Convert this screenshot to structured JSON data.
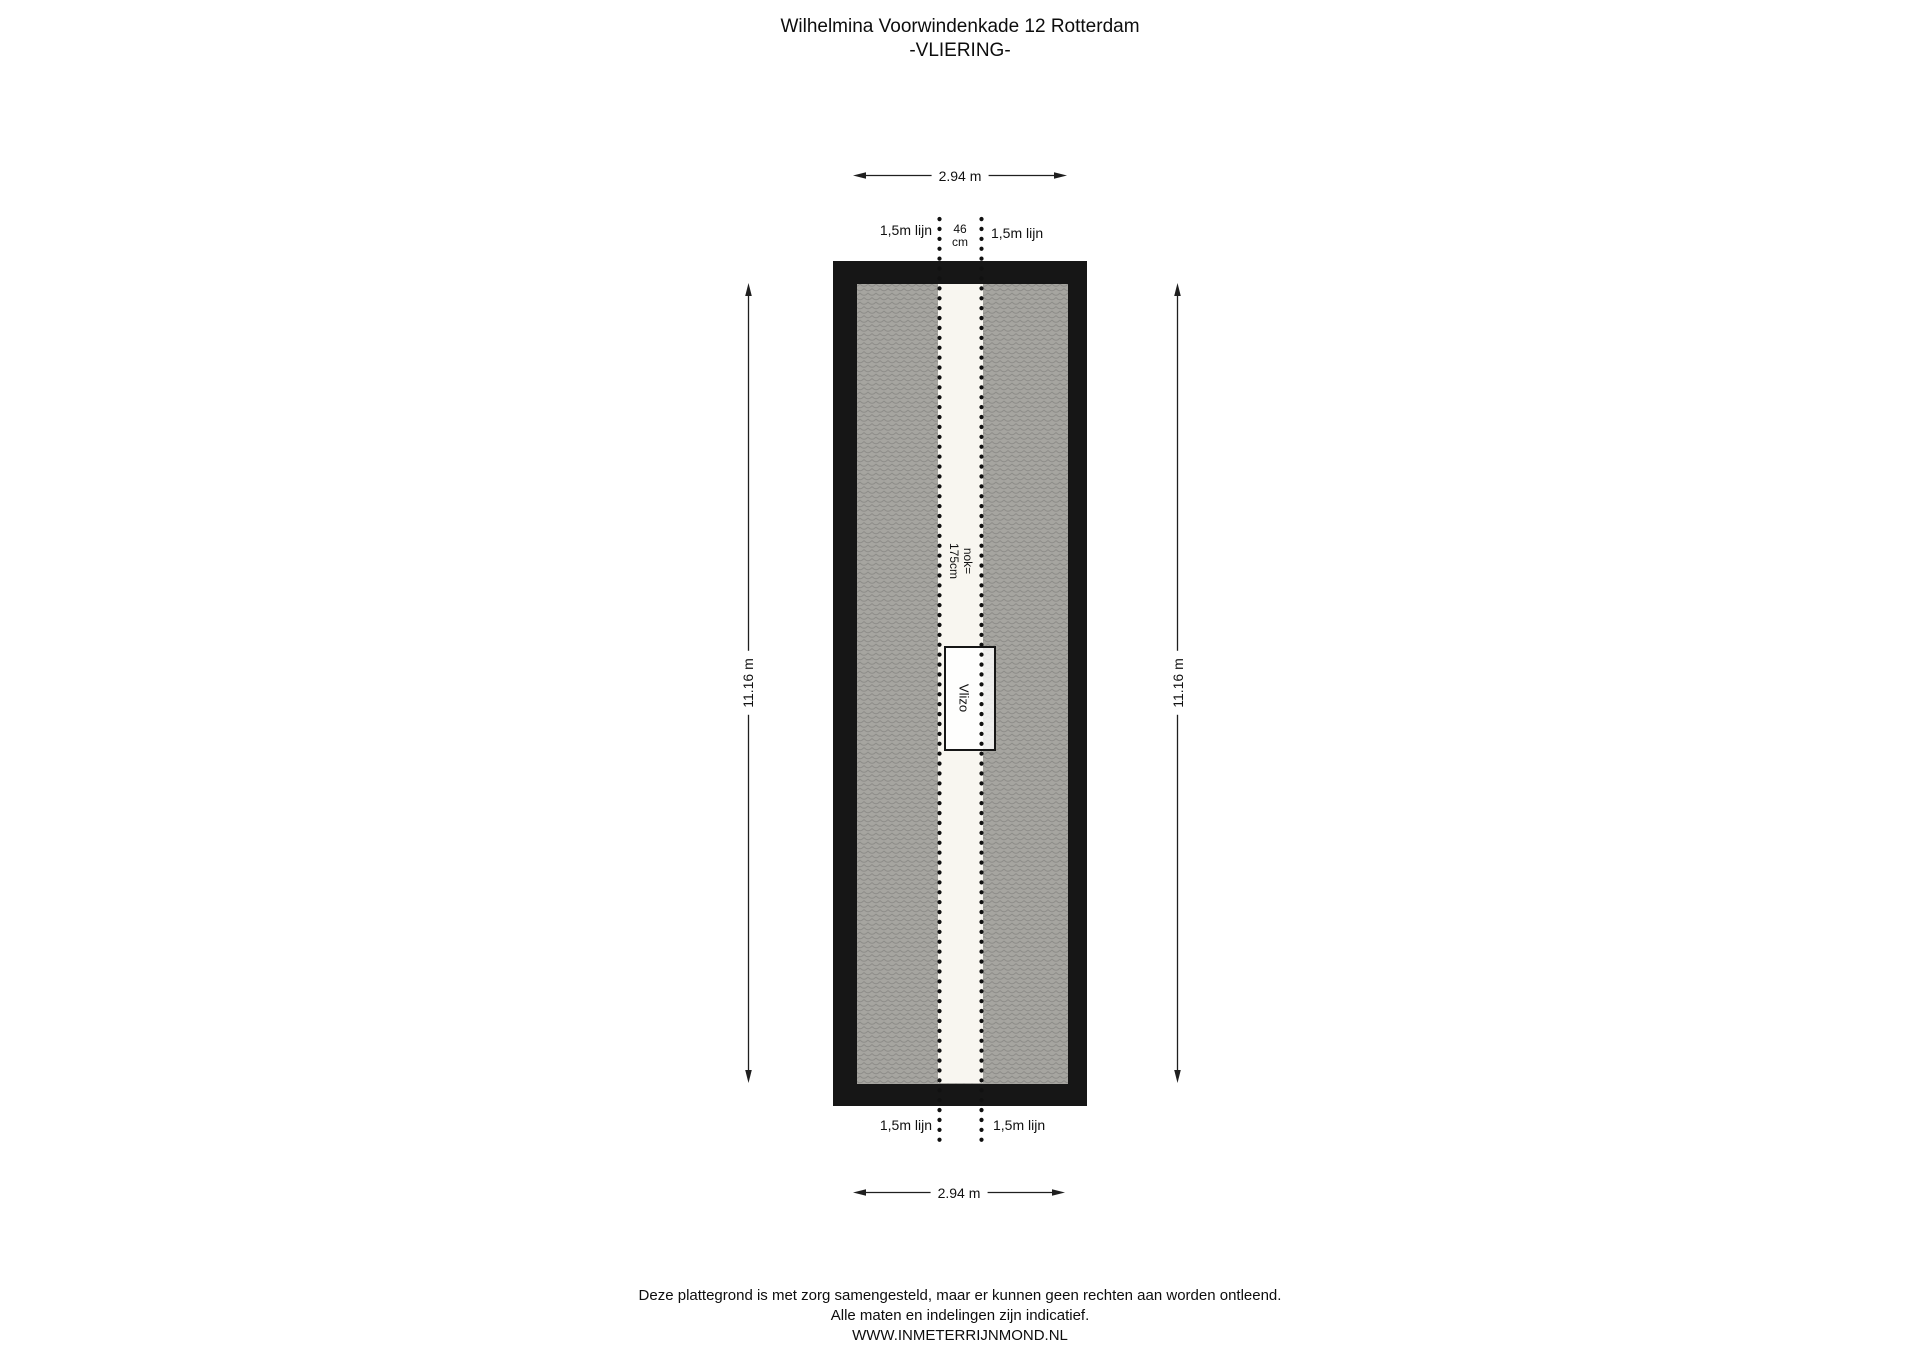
{
  "title": {
    "address": "Wilhelmina Voorwindenkade 12 Rotterdam",
    "floor": "-VLIERING-"
  },
  "dimensions": {
    "top_width": "2.94 m",
    "bottom_width": "2.94 m",
    "left_height": "11.16 m",
    "right_height": "11.16 m"
  },
  "annotations": {
    "top_left_height_line": "1,5m lijn",
    "top_ridge_width_value": "46",
    "top_ridge_width_unit": "cm",
    "top_right_height_line": "1,5m lijn",
    "bottom_left_height_line": "1,5m lijn",
    "bottom_right_height_line": "1,5m lijn",
    "ridge_height_line1": "nok=",
    "ridge_height_line2": "175cm",
    "loft_ladder": "Vlizo"
  },
  "footer": {
    "disclaimer_line1": "Deze plattegrond is met zorg samengesteld, maar er kunnen geen rechten aan worden ontleend.",
    "disclaimer_line2": "Alle maten en indelingen zijn indicatief.",
    "website": "WWW.INMETERRIJNMOND.NL"
  },
  "colors": {
    "wall": "#161616",
    "hatch_bg": "#a6a5a0",
    "hatch_line": "#8e8d89",
    "ridge_strip": "#f8f6f0",
    "vlizo_box": "#ffffff",
    "dimension": "#1f1f1f",
    "dotted_line": "#111111"
  }
}
